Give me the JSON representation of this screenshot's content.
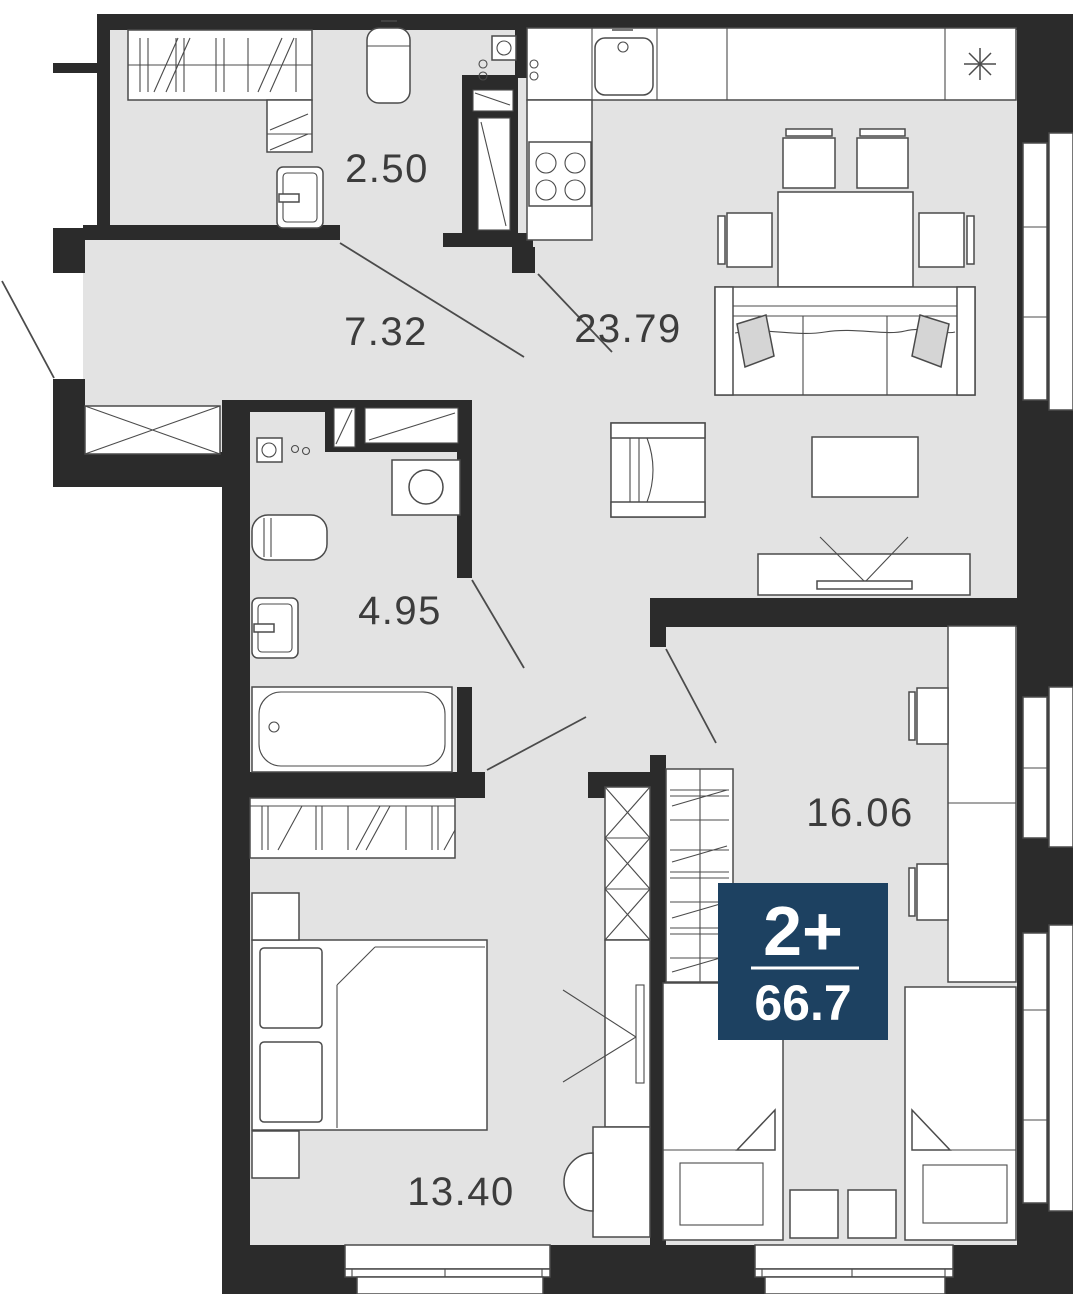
{
  "plan": {
    "badge": {
      "rooms_label": "2+",
      "total_area": "66.7",
      "bg_color": "#1d4161",
      "text_color": "#ffffff"
    },
    "rooms": [
      {
        "id": "storage",
        "area": "2.50"
      },
      {
        "id": "hallway",
        "area": "7.32"
      },
      {
        "id": "kitchen-living-room",
        "area": "23.79"
      },
      {
        "id": "bathroom",
        "area": "4.95"
      },
      {
        "id": "bedroom-right",
        "area": "16.06"
      },
      {
        "id": "bedroom-left",
        "area": "13.40"
      }
    ],
    "colors": {
      "wall": "#2b2b2b",
      "floor": "#e3e3e3",
      "line": "#4b4b4b",
      "cushion": "#d5d5d5",
      "badge_bg": "#1d4161"
    }
  }
}
